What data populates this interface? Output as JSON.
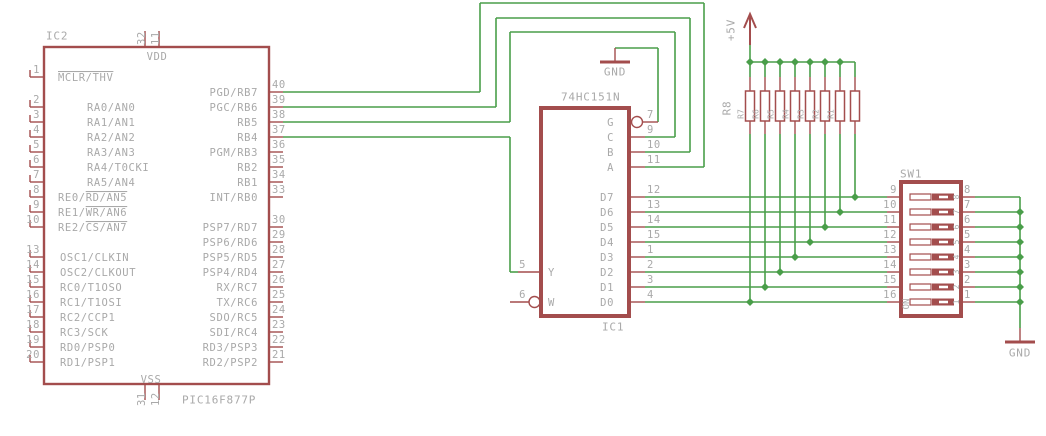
{
  "canvas": {
    "w": 1046,
    "h": 436
  },
  "colors": {
    "wire": "#4a9e4a",
    "part": "#a34d4d",
    "text": "#a9a9a9",
    "fill": "#ffffff"
  },
  "labels": {
    "ic2_ref": "IC2",
    "ic2_value": "PIC16F877P",
    "vdd": "VDD",
    "vss": "VSS",
    "ic1_ref": "IC1",
    "ic1_value": "74HC151N",
    "sw_ref": "SW1",
    "sw_on": "ON",
    "rnet_ref": "R8",
    "vcc": "+5V",
    "gnd_top": "GND",
    "gnd_bottom": "GND"
  },
  "ic2": {
    "box": [
      44,
      47,
      225,
      337
    ],
    "stroke": 2.4,
    "left_pins": [
      {
        "n": "1",
        "y": 77,
        "nx": 58,
        "name": [
          [
            "MCLR/THV",
            1
          ]
        ]
      },
      {
        "n": "2",
        "y": 107,
        "nx": 87,
        "name": [
          [
            "RA0/AN0",
            0
          ]
        ]
      },
      {
        "n": "3",
        "y": 122,
        "nx": 87,
        "name": [
          [
            "RA1/AN1",
            0
          ]
        ]
      },
      {
        "n": "4",
        "y": 137,
        "nx": 87,
        "name": [
          [
            "RA2/AN2",
            0
          ]
        ]
      },
      {
        "n": "5",
        "y": 152,
        "nx": 87,
        "name": [
          [
            "RA3/AN3",
            0
          ]
        ]
      },
      {
        "n": "6",
        "y": 167,
        "nx": 87,
        "name": [
          [
            "RA4/T0CKI",
            0
          ]
        ]
      },
      {
        "n": "7",
        "y": 182,
        "nx": 87,
        "name": [
          [
            "RA5/AN4",
            0
          ]
        ]
      },
      {
        "n": "8",
        "y": 197,
        "nx": 58,
        "name": [
          [
            "RE0/",
            0
          ],
          [
            "RD/AN5",
            1
          ]
        ]
      },
      {
        "n": "9",
        "y": 212,
        "nx": 58,
        "name": [
          [
            "RE1/",
            0
          ],
          [
            "WR/AN6",
            1
          ]
        ]
      },
      {
        "n": "10",
        "y": 227,
        "nx": 58,
        "name": [
          [
            "RE2/",
            0
          ],
          [
            "CS/AN7",
            1
          ]
        ]
      },
      {
        "n": "13",
        "y": 257,
        "nx": 60,
        "name": [
          [
            "OSC1/CLKIN",
            0
          ]
        ]
      },
      {
        "n": "14",
        "y": 272,
        "nx": 60,
        "name": [
          [
            "OSC2/CLKOUT",
            0
          ]
        ]
      },
      {
        "n": "15",
        "y": 287,
        "nx": 60,
        "name": [
          [
            "RC0/T1OSO",
            0
          ]
        ]
      },
      {
        "n": "16",
        "y": 302,
        "nx": 60,
        "name": [
          [
            "RC1/T1OSI",
            0
          ]
        ]
      },
      {
        "n": "17",
        "y": 317,
        "nx": 60,
        "name": [
          [
            "RC2/CCP1",
            0
          ]
        ]
      },
      {
        "n": "18",
        "y": 332,
        "nx": 60,
        "name": [
          [
            "RC3/SCK",
            0
          ]
        ]
      },
      {
        "n": "19",
        "y": 347,
        "nx": 60,
        "name": [
          [
            "RD0/PSP0",
            0
          ]
        ]
      },
      {
        "n": "20",
        "y": 362,
        "nx": 60,
        "name": [
          [
            "RD1/PSP1",
            0
          ]
        ]
      }
    ],
    "right_pins": [
      {
        "n": "40",
        "y": 92,
        "name": [
          [
            "PGD/RB7",
            0
          ]
        ]
      },
      {
        "n": "39",
        "y": 107,
        "name": [
          [
            "PGC/RB6",
            0
          ]
        ]
      },
      {
        "n": "38",
        "y": 122,
        "name": [
          [
            "RB5",
            0
          ]
        ]
      },
      {
        "n": "37",
        "y": 137,
        "name": [
          [
            "RB4",
            0
          ]
        ]
      },
      {
        "n": "36",
        "y": 152,
        "name": [
          [
            "PGM/RB3",
            0
          ]
        ]
      },
      {
        "n": "35",
        "y": 167,
        "name": [
          [
            "RB2",
            0
          ]
        ]
      },
      {
        "n": "34",
        "y": 182,
        "name": [
          [
            "RB1",
            0
          ]
        ]
      },
      {
        "n": "33",
        "y": 197,
        "name": [
          [
            "INT/RB0",
            0
          ]
        ]
      },
      {
        "n": "30",
        "y": 227,
        "name": [
          [
            "PSP7/RD7",
            0
          ]
        ]
      },
      {
        "n": "29",
        "y": 242,
        "name": [
          [
            "PSP6/RD6",
            0
          ]
        ]
      },
      {
        "n": "28",
        "y": 257,
        "name": [
          [
            "PSP5/RD5",
            0
          ]
        ]
      },
      {
        "n": "27",
        "y": 272,
        "name": [
          [
            "PSP4/RD4",
            0
          ]
        ]
      },
      {
        "n": "26",
        "y": 287,
        "name": [
          [
            "RX/RC7",
            0
          ]
        ]
      },
      {
        "n": "25",
        "y": 302,
        "name": [
          [
            "TX/RC6",
            0
          ]
        ]
      },
      {
        "n": "24",
        "y": 317,
        "name": [
          [
            "SDO/RC5",
            0
          ]
        ]
      },
      {
        "n": "23",
        "y": 332,
        "name": [
          [
            "SDI/RC4",
            0
          ]
        ]
      },
      {
        "n": "22",
        "y": 347,
        "name": [
          [
            "RD3/PSP3",
            0
          ]
        ]
      },
      {
        "n": "21",
        "y": 362,
        "name": [
          [
            "RD2/PSP2",
            0
          ]
        ]
      }
    ],
    "top_pins": [
      {
        "n": "32",
        "x": 145
      },
      {
        "n": "11",
        "x": 159
      }
    ],
    "bottom_pins": [
      {
        "n": "31",
        "x": 145
      },
      {
        "n": "12",
        "x": 159
      }
    ]
  },
  "ic1": {
    "box": [
      541,
      108,
      88,
      208
    ],
    "stroke": 4,
    "right_pins": [
      {
        "n": "7",
        "y": 122,
        "name": "G",
        "inv": 1
      },
      {
        "n": "9",
        "y": 137,
        "name": "C"
      },
      {
        "n": "10",
        "y": 152,
        "name": "B"
      },
      {
        "n": "11",
        "y": 167,
        "name": "A"
      },
      {
        "n": "12",
        "y": 197,
        "name": "D7"
      },
      {
        "n": "13",
        "y": 212,
        "name": "D6"
      },
      {
        "n": "14",
        "y": 227,
        "name": "D5"
      },
      {
        "n": "15",
        "y": 242,
        "name": "D4"
      },
      {
        "n": "1",
        "y": 257,
        "name": "D3"
      },
      {
        "n": "2",
        "y": 272,
        "name": "D2"
      },
      {
        "n": "3",
        "y": 287,
        "name": "D1"
      },
      {
        "n": "4",
        "y": 302,
        "name": "D0"
      }
    ],
    "left_pins": [
      {
        "n": "5",
        "y": 272,
        "name": "Y"
      },
      {
        "n": "6",
        "y": 302,
        "name": "W",
        "inv": 1
      }
    ]
  },
  "sw1": {
    "box": [
      901,
      182,
      60,
      134
    ],
    "stroke": 4,
    "rows": [
      {
        "ln": "9",
        "rn": "8",
        "d": "8",
        "y": 197
      },
      {
        "ln": "10",
        "rn": "7",
        "d": "7",
        "y": 212
      },
      {
        "ln": "11",
        "rn": "6",
        "d": "6",
        "y": 227
      },
      {
        "ln": "12",
        "rn": "5",
        "d": "5",
        "y": 242
      },
      {
        "ln": "13",
        "rn": "4",
        "d": "4",
        "y": 257
      },
      {
        "ln": "14",
        "rn": "3",
        "d": "3",
        "y": 272
      },
      {
        "ln": "15",
        "rn": "2",
        "d": "2",
        "y": 287
      },
      {
        "ln": "16",
        "rn": "1",
        "d": "1",
        "y": 302
      }
    ]
  },
  "rnet": {
    "xs": [
      750,
      765,
      780,
      795,
      810,
      825,
      840,
      855
    ],
    "body_top": 91,
    "body_bottom": 121,
    "body_w": 9,
    "labels": [
      {
        "t": "R7",
        "x": 741
      },
      {
        "t": "R6",
        "x": 756
      },
      {
        "t": "R5",
        "x": 771
      },
      {
        "t": "R4",
        "x": 786
      },
      {
        "t": "R3",
        "x": 801
      },
      {
        "t": "R2",
        "x": 816
      },
      {
        "t": "R1",
        "x": 831
      }
    ],
    "label_y": 114
  },
  "power": {
    "vcc": {
      "x": 750,
      "tip": 14,
      "base": 28,
      "half": 6,
      "shaft_bottom": 45
    },
    "gnd_top": {
      "cx": 615,
      "pin_top": 48,
      "bar_y": 62,
      "half": 15
    },
    "gnd_bot": {
      "cx": 1020,
      "pin_top": 328,
      "bar_y": 342,
      "half": 15
    }
  },
  "wires": [
    [
      283,
      92,
      480,
      92
    ],
    [
      480,
      92,
      480,
      3
    ],
    [
      480,
      3,
      704,
      3
    ],
    [
      704,
      3,
      704,
      167
    ],
    [
      645,
      167,
      704,
      167
    ],
    [
      283,
      107,
      496,
      107
    ],
    [
      496,
      107,
      496,
      18
    ],
    [
      496,
      18,
      690,
      18
    ],
    [
      690,
      18,
      690,
      152
    ],
    [
      645,
      152,
      690,
      152
    ],
    [
      283,
      122,
      510,
      122
    ],
    [
      510,
      122,
      510,
      32
    ],
    [
      510,
      32,
      675,
      32
    ],
    [
      675,
      32,
      675,
      137
    ],
    [
      645,
      137,
      675,
      137
    ],
    [
      283,
      137,
      510,
      137
    ],
    [
      510,
      137,
      510,
      272
    ],
    [
      510,
      272,
      518,
      272
    ],
    [
      615,
      48,
      658,
      48
    ],
    [
      658,
      48,
      658,
      122
    ],
    [
      645,
      197,
      887,
      197
    ],
    [
      645,
      212,
      887,
      212
    ],
    [
      645,
      227,
      887,
      227
    ],
    [
      645,
      242,
      887,
      242
    ],
    [
      645,
      257,
      887,
      257
    ],
    [
      645,
      272,
      887,
      272
    ],
    [
      645,
      287,
      887,
      287
    ],
    [
      645,
      302,
      887,
      302
    ],
    [
      975,
      197,
      1020,
      197
    ],
    [
      975,
      212,
      1020,
      212
    ],
    [
      975,
      227,
      1020,
      227
    ],
    [
      975,
      242,
      1020,
      242
    ],
    [
      975,
      257,
      1020,
      257
    ],
    [
      975,
      272,
      1020,
      272
    ],
    [
      975,
      287,
      1020,
      287
    ],
    [
      975,
      302,
      1020,
      302
    ],
    [
      1020,
      197,
      1020,
      328
    ],
    [
      750,
      134,
      750,
      302
    ],
    [
      765,
      134,
      765,
      287
    ],
    [
      780,
      134,
      780,
      272
    ],
    [
      795,
      134,
      795,
      257
    ],
    [
      810,
      134,
      810,
      242
    ],
    [
      825,
      134,
      825,
      227
    ],
    [
      840,
      134,
      840,
      212
    ],
    [
      855,
      134,
      855,
      197
    ],
    [
      750,
      62,
      750,
      77
    ],
    [
      765,
      62,
      765,
      77
    ],
    [
      780,
      62,
      780,
      77
    ],
    [
      795,
      62,
      795,
      77
    ],
    [
      810,
      62,
      810,
      77
    ],
    [
      825,
      62,
      825,
      77
    ],
    [
      840,
      62,
      840,
      77
    ],
    [
      855,
      62,
      855,
      77
    ],
    [
      750,
      62,
      855,
      62
    ],
    [
      750,
      45,
      750,
      62
    ]
  ],
  "junctions": [
    [
      750,
      62
    ],
    [
      765,
      62
    ],
    [
      780,
      62
    ],
    [
      795,
      62
    ],
    [
      810,
      62
    ],
    [
      825,
      62
    ],
    [
      840,
      62
    ],
    [
      750,
      302
    ],
    [
      765,
      287
    ],
    [
      780,
      272
    ],
    [
      795,
      257
    ],
    [
      810,
      242
    ],
    [
      825,
      227
    ],
    [
      840,
      212
    ],
    [
      855,
      197
    ],
    [
      1020,
      212
    ],
    [
      1020,
      227
    ],
    [
      1020,
      242
    ],
    [
      1020,
      257
    ],
    [
      1020,
      272
    ],
    [
      1020,
      287
    ],
    [
      1020,
      302
    ]
  ]
}
